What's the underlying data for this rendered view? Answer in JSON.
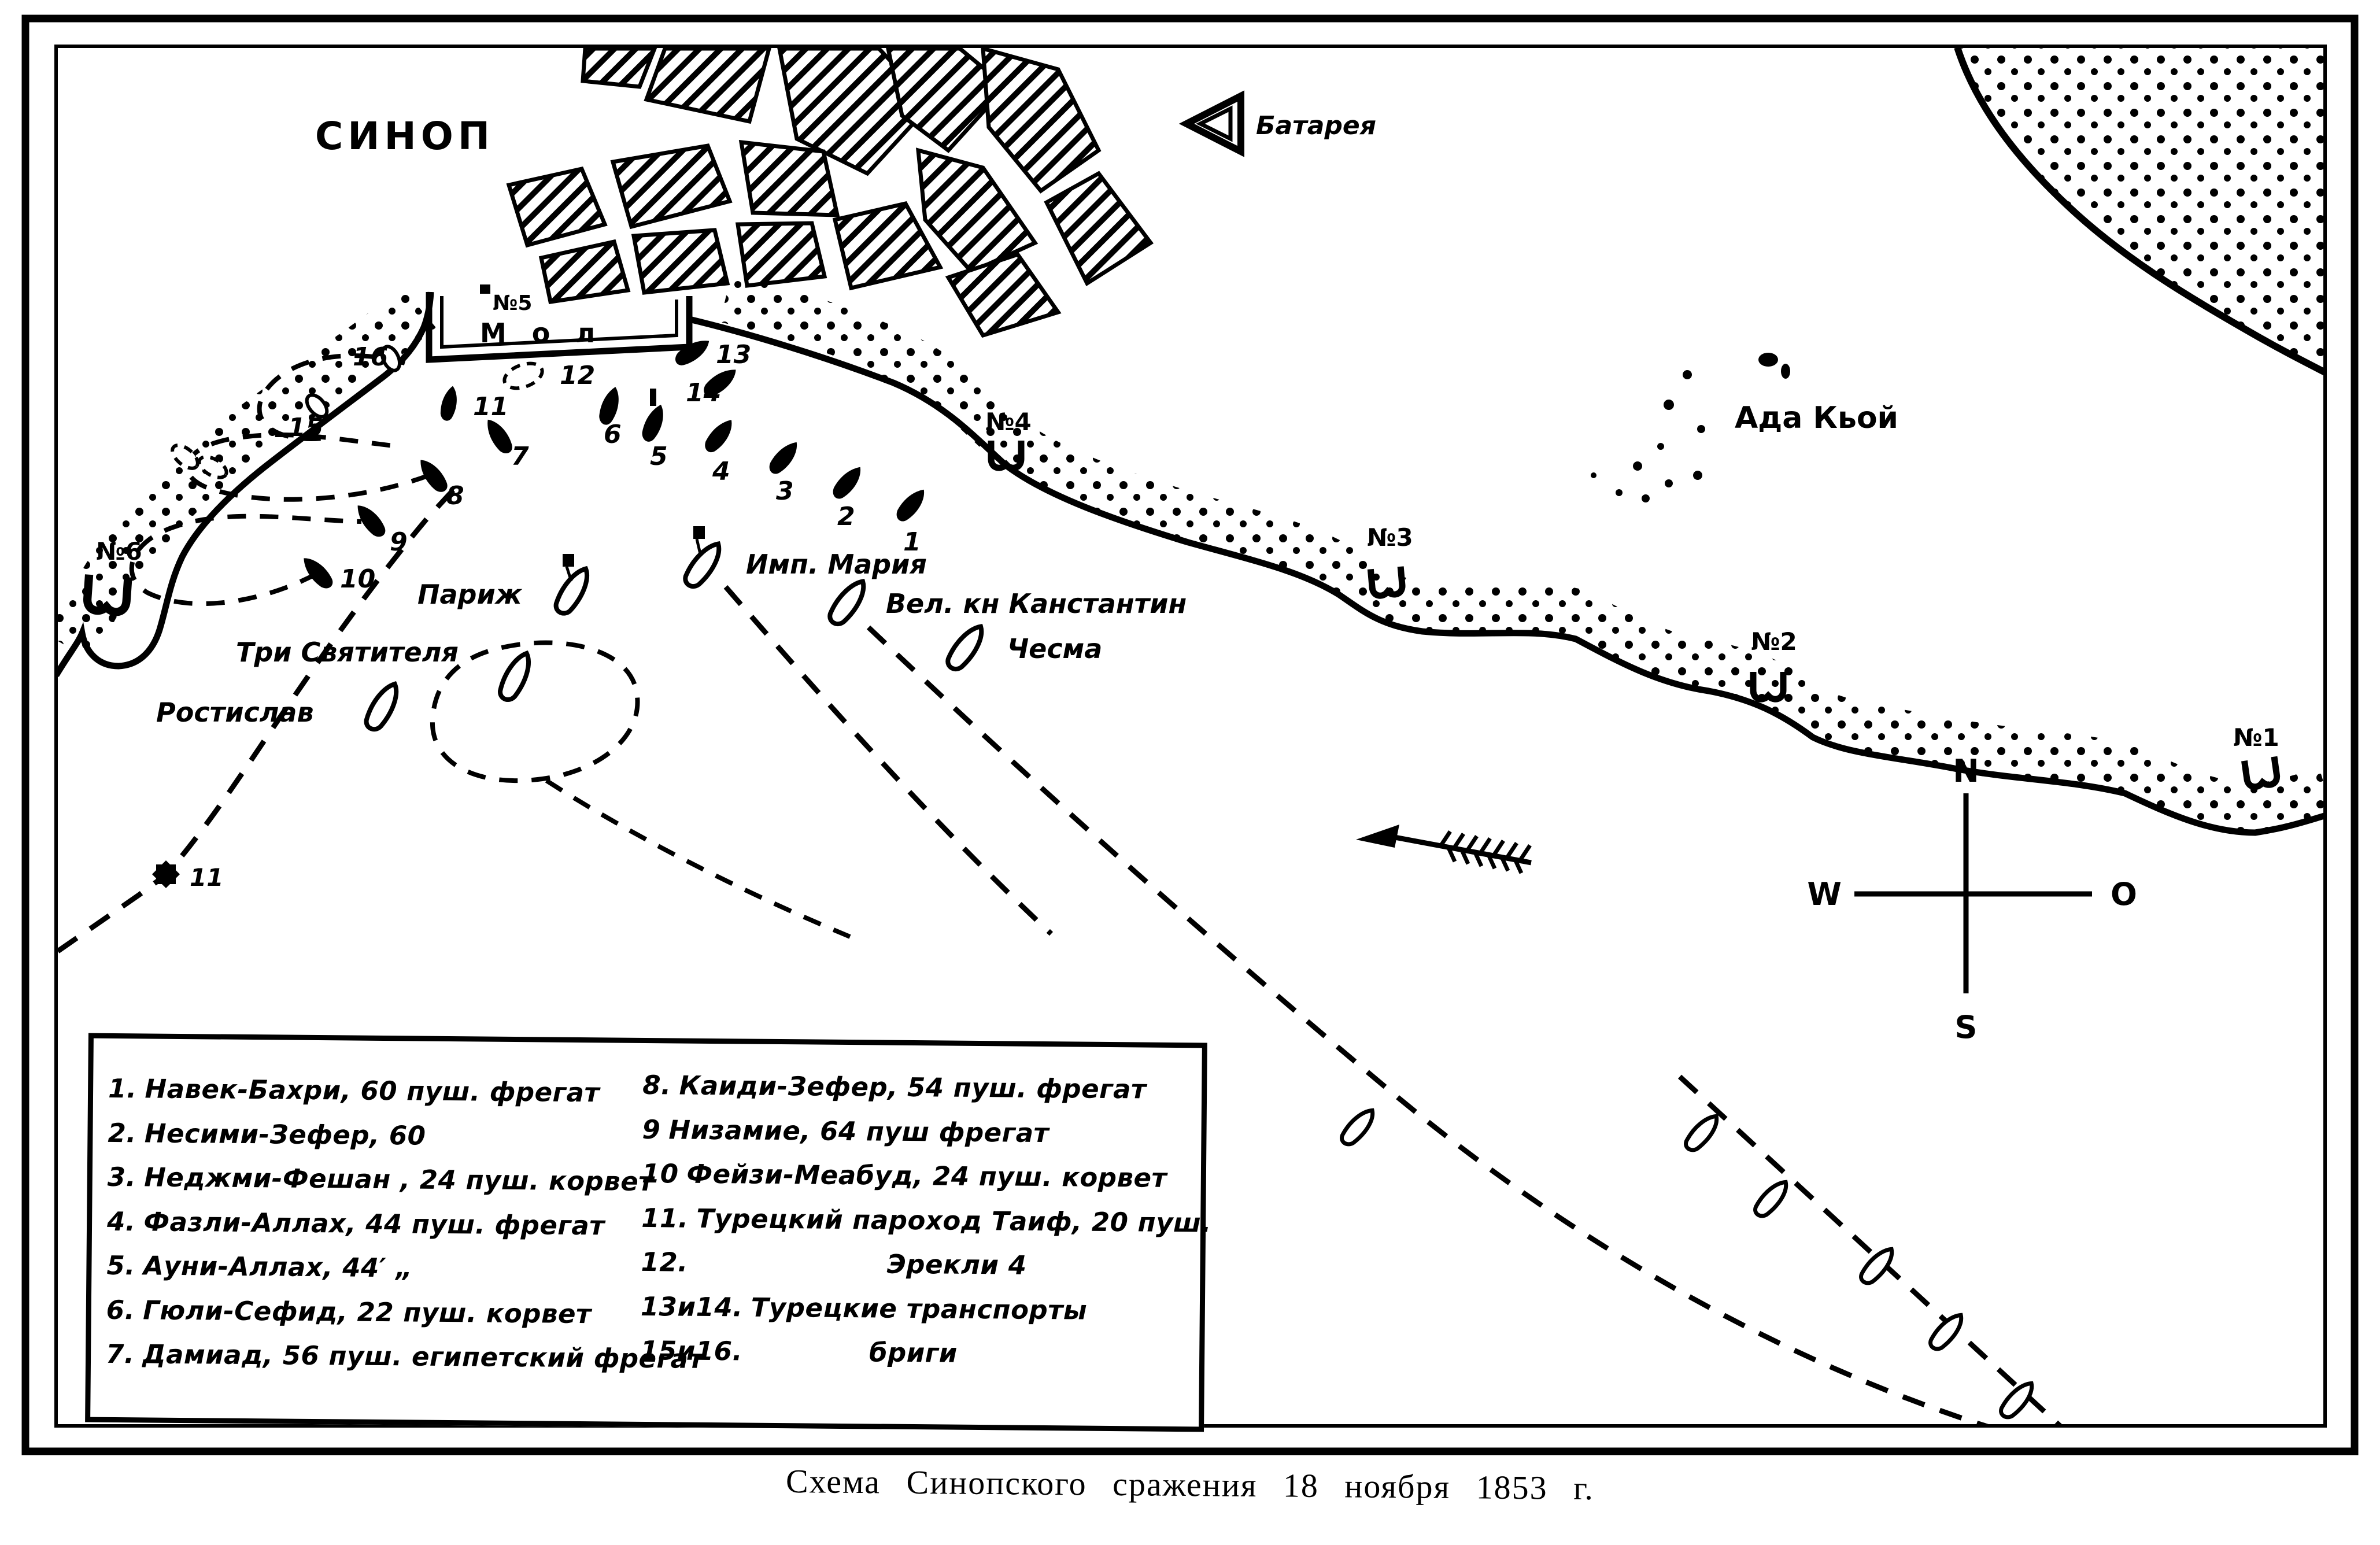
{
  "caption": "Схема Синопского сражения 18 ноября 1853 г.",
  "city": {
    "name": "СИНОП",
    "mole": "М о л"
  },
  "symbols_legend": {
    "battery": "Батарея"
  },
  "village": {
    "name": "Ада Кьой"
  },
  "compass": {
    "n": "N",
    "s": "S",
    "w": "W",
    "o": "O"
  },
  "batteries": [
    {
      "label": "№1"
    },
    {
      "label": "№2"
    },
    {
      "label": "№3"
    },
    {
      "label": "№4"
    },
    {
      "label": "№5"
    },
    {
      "label": "№6"
    }
  ],
  "russian_ships": [
    {
      "name": "Имп. Мария"
    },
    {
      "name": "Вел. кн Канстантин"
    },
    {
      "name": "Чесма"
    },
    {
      "name": "Париж"
    },
    {
      "name": "Три Святителя"
    },
    {
      "name": "Ростислав"
    }
  ],
  "turkish_ships": [
    {
      "num": "1"
    },
    {
      "num": "2"
    },
    {
      "num": "3"
    },
    {
      "num": "4"
    },
    {
      "num": "5"
    },
    {
      "num": "6"
    },
    {
      "num": "7"
    },
    {
      "num": "8"
    },
    {
      "num": "9"
    },
    {
      "num": "10"
    },
    {
      "num": "11"
    },
    {
      "num": "12"
    },
    {
      "num": "13"
    },
    {
      "num": "14"
    },
    {
      "num": "15"
    },
    {
      "num": "16"
    }
  ],
  "legend": {
    "left": [
      {
        "num": "1.",
        "text": "Навек-Бахри, 60 пуш. фрегат"
      },
      {
        "num": "2.",
        "text": "Несими-Зефер, 60"
      },
      {
        "num": "3.",
        "text": "Неджми-Фешан , 24 пуш. корвет"
      },
      {
        "num": "4.",
        "text": "Фазли-Аллах, 44 пуш. фрегат"
      },
      {
        "num": "5.",
        "text": "Ауни-Аллах, 44′ „"
      },
      {
        "num": "6.",
        "text": "Гюли-Сефид, 22 пуш. корвет"
      },
      {
        "num": "7.",
        "text": "Дамиад, 56 пуш. египетский фрегат"
      }
    ],
    "right": [
      {
        "num": "8.",
        "text": "Каиди-Зефер, 54 пуш. фрегат"
      },
      {
        "num": "9",
        "text": "Низамие, 64 пуш фрегат"
      },
      {
        "num": "10",
        "text": "Фейзи-Меабуд, 24 пуш. корвет"
      },
      {
        "num": "11.",
        "text": "Турецкий пароход Таиф, 20 пуш."
      },
      {
        "num": "12.",
        "text": "Эрекли 4"
      },
      {
        "num": "13и14.",
        "text": "Турецкие транспорты"
      },
      {
        "num": "15и16.",
        "text": "бриги"
      }
    ]
  }
}
